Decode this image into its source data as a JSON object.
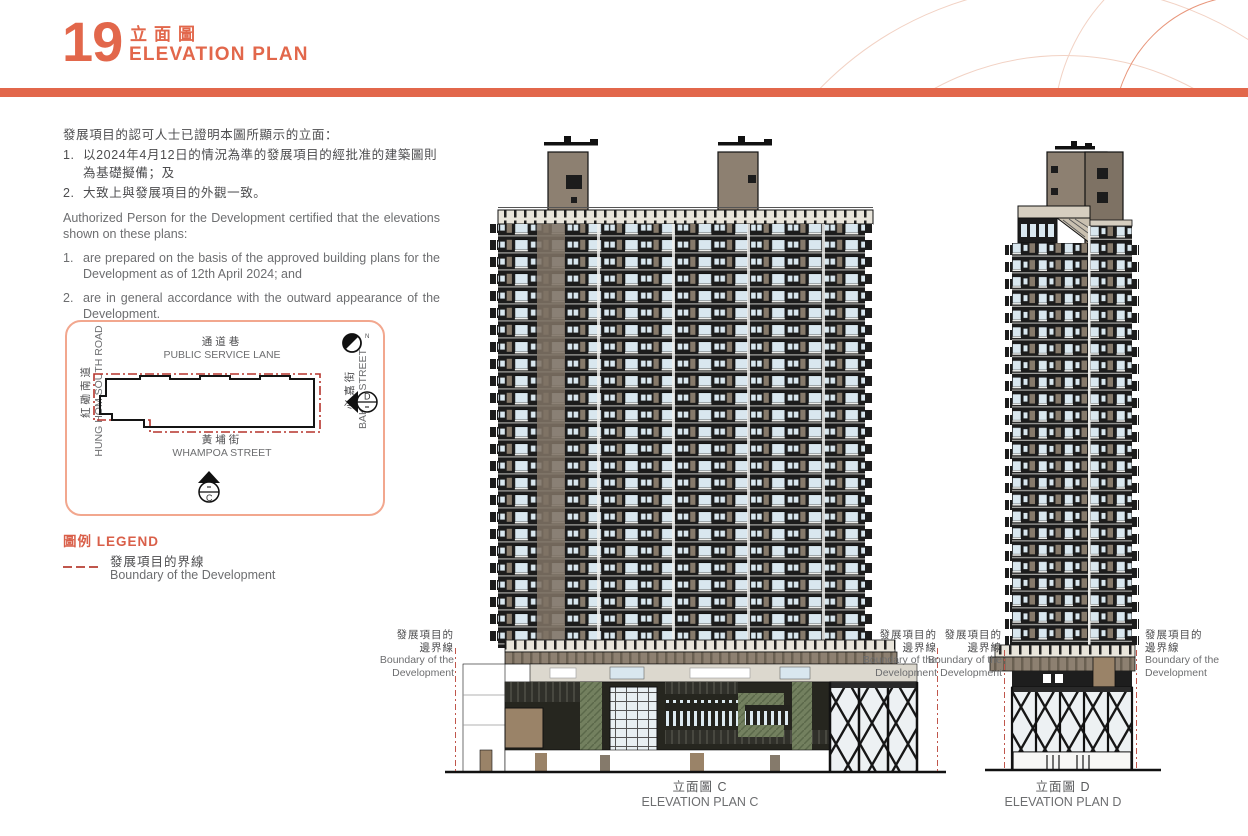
{
  "page": {
    "number": "19",
    "title_zh": "立面圖",
    "title_en": "ELEVATION PLAN"
  },
  "colors": {
    "accent": "#E2674B",
    "boundary_red": "#B5342C"
  },
  "certification": {
    "zh_intro": "發展項目的認可人士已證明本圖所顯示的立面：",
    "zh_items": [
      {
        "num": "1.",
        "text": "以2024年4月12日的情況為準的發展項目的經批准的建築圖則為基礎擬備；及"
      },
      {
        "num": "2.",
        "text": "大致上與發展項目的外觀一致。"
      }
    ],
    "en_intro": "Authorized Person for the Development certified that the elevations shown on these plans:",
    "en_items": [
      {
        "num": "1.",
        "text": "are prepared on the basis of the approved building plans for the Development as of 12th April 2024; and"
      },
      {
        "num": "2.",
        "text": "are in general accordance with the outward appearance of the Development."
      }
    ]
  },
  "site_plan": {
    "north": "N",
    "road_top_zh": "通道巷",
    "road_top_en": "PUBLIC SERVICE LANE",
    "road_left_zh": "紅磡南道",
    "road_left_en": "HUNG HOM SOUTH ROAD",
    "road_right_zh": "必嘉街",
    "road_right_en": "BAKER STREET",
    "road_bottom_zh": "黃埔街",
    "road_bottom_en": "WHAMPOA STREET",
    "marker_d": "D",
    "marker_c": "C"
  },
  "legend": {
    "title": "圖例 LEGEND",
    "boundary_zh": "發展項目的界線",
    "boundary_en": "Boundary of the Development"
  },
  "boundary_note": {
    "zh_line1": "發展項目的",
    "zh_line2": "邊界線",
    "en_line1": "Boundary of the",
    "en_line2": "Development"
  },
  "captions": {
    "c_zh": "立面圖 C",
    "c_en": "ELEVATION PLAN C",
    "d_zh": "立面圖 D",
    "d_en": "ELEVATION PLAN D"
  }
}
